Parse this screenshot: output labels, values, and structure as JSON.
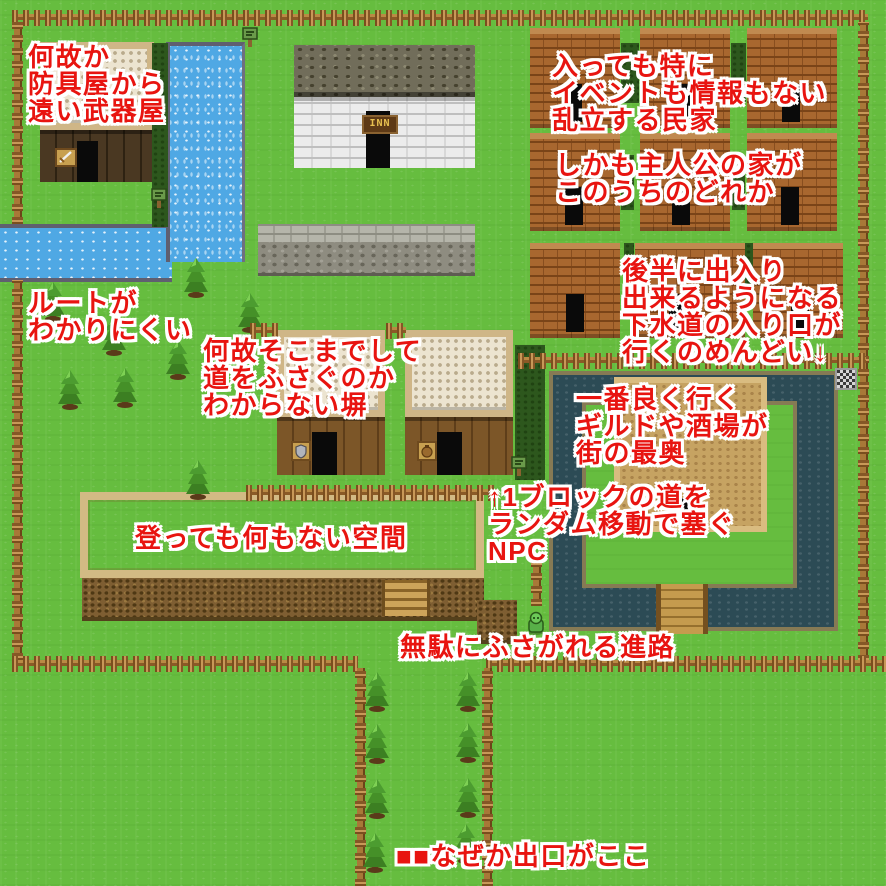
{
  "colors": {
    "grass": "#66bd3f",
    "water_river": "#4fa8e4",
    "water_moat": "#2c4b55",
    "brick": "#a8672f",
    "sand": "#c6a362",
    "fence_wood": "#9a6a2e",
    "annotation_red": "#e81410"
  },
  "inn": {
    "sign": "INN"
  },
  "annotations": {
    "weapon_shop_far": {
      "lines": [
        "何故か",
        "防具屋から",
        "遠い武器屋"
      ]
    },
    "houses_no_events": {
      "lines": [
        "入っても特に",
        "イベントも情報もない",
        "乱立する民家"
      ]
    },
    "protagonist_house": {
      "lines": [
        "しかも主人公の家が",
        "このうちのどれか"
      ]
    },
    "route_unclear": {
      "lines": [
        "ルートが",
        "わかりにくい"
      ]
    },
    "pointless_wall": {
      "lines": [
        "何故そこまでして",
        "道をふさぐのか",
        "わからない塀"
      ]
    },
    "sewer_entrance": {
      "lines": [
        "後半に出入り",
        "出来るようになる",
        "下水道の入り口が",
        "行くのめんどい↓"
      ]
    },
    "guild_far": {
      "lines": [
        "一番良く行く",
        "ギルドや酒場が",
        "街の最奥"
      ]
    },
    "npc_blocker": {
      "lines": [
        "↑1ブロックの道を",
        "ランダム移動で塞ぐ",
        "NPC"
      ]
    },
    "empty_space": {
      "lines": [
        "登っても何もない空間"
      ]
    },
    "blocked_path": {
      "lines": [
        "無駄にふさがれる進路"
      ]
    },
    "exit_here": {
      "lines": [
        "■■なぜか出口がここ"
      ]
    }
  }
}
